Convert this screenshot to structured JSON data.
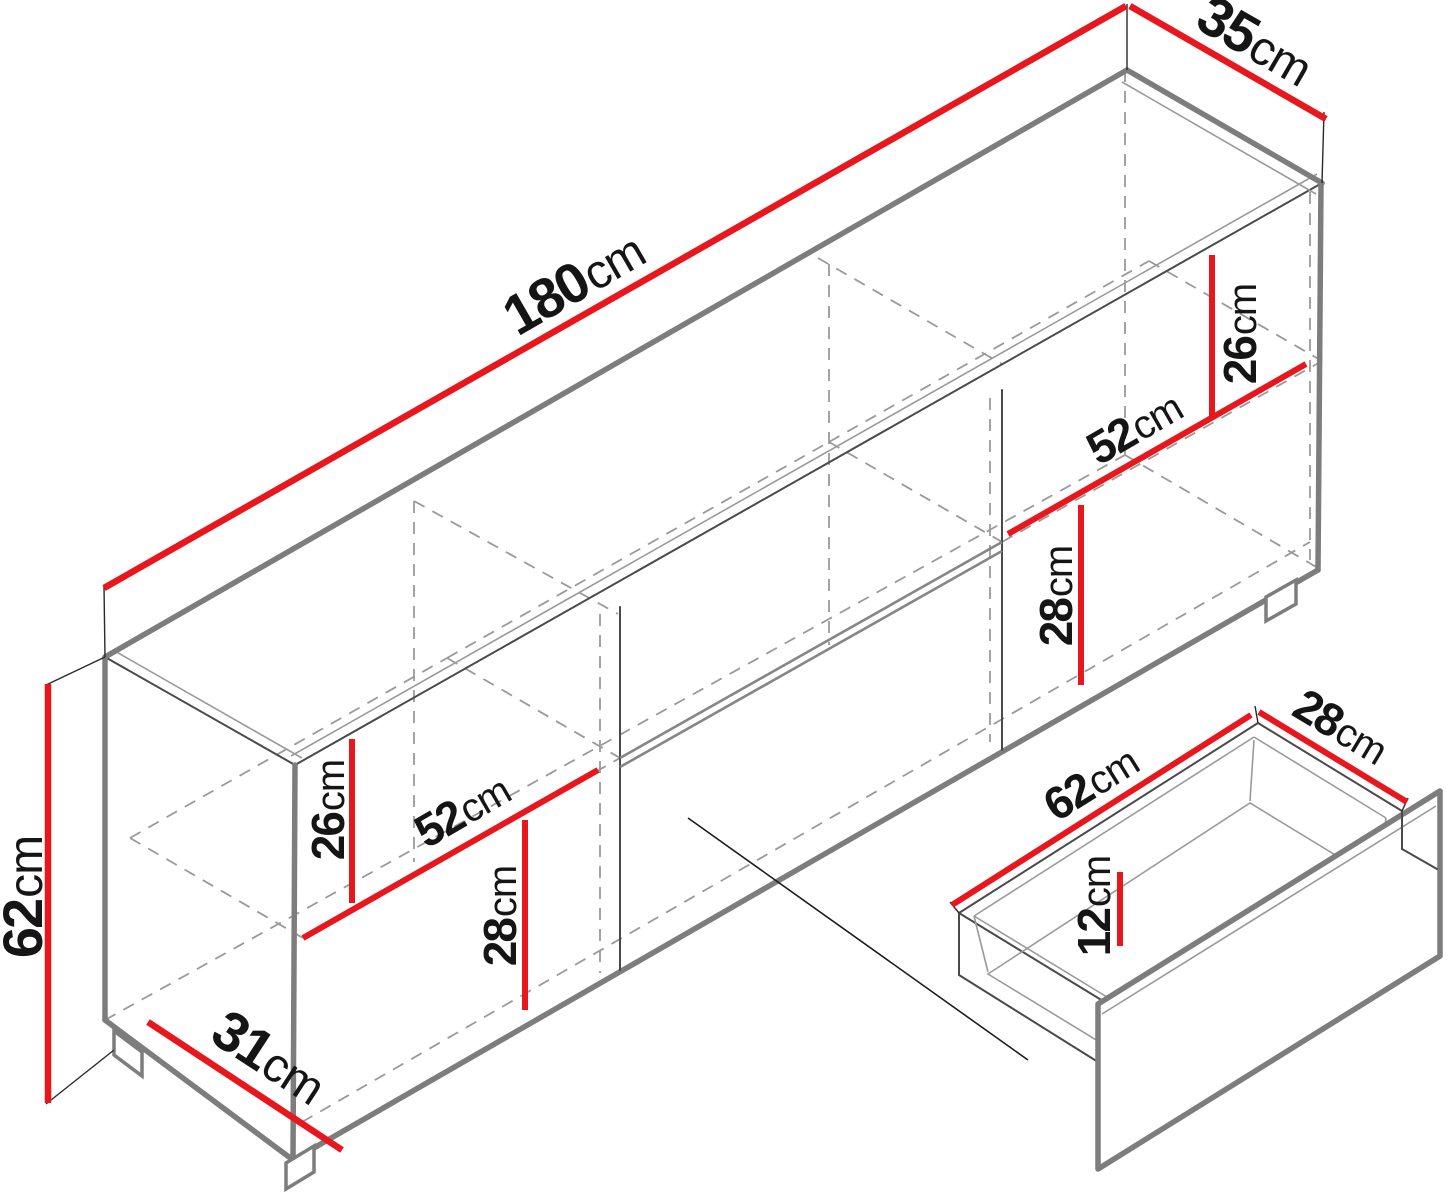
{
  "figure": {
    "type": "isometric-dimension-diagram",
    "subject": "sideboard cabinet with pull-out drawer detail",
    "unit": "cm"
  },
  "colors": {
    "dimension-red": "#e8171d",
    "outline-gray": "#7d7d7d",
    "outline-dark": "#4a4a4a",
    "hidden-gray": "#9a9a9a",
    "label-dark": "#151515",
    "background": "#ffffff"
  },
  "labels": {
    "width": {
      "num": "180",
      "unit": "cm"
    },
    "depth": {
      "num": "35",
      "unit": "cm"
    },
    "height": {
      "num": "62",
      "unit": "cm"
    },
    "base_depth": {
      "num": "31",
      "unit": "cm"
    },
    "left_upper_height": {
      "num": "26",
      "unit": "cm"
    },
    "left_width": {
      "num": "52",
      "unit": "cm"
    },
    "left_lower_height": {
      "num": "28",
      "unit": "cm"
    },
    "right_upper_height": {
      "num": "26",
      "unit": "cm"
    },
    "right_width": {
      "num": "52",
      "unit": "cm"
    },
    "right_lower_height": {
      "num": "28",
      "unit": "cm"
    },
    "drawer_width": {
      "num": "62",
      "unit": "cm"
    },
    "drawer_depth": {
      "num": "28",
      "unit": "cm"
    },
    "drawer_height": {
      "num": "12",
      "unit": "cm"
    }
  }
}
